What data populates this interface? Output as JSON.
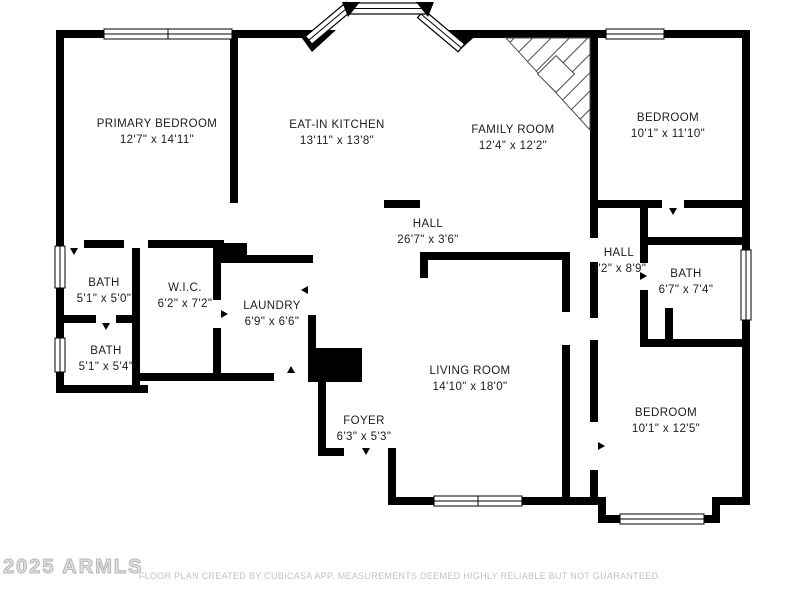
{
  "rooms": {
    "primary_bedroom": {
      "name": "PRIMARY BEDROOM",
      "dims": "12'7\" x 14'11\""
    },
    "eat_in_kitchen": {
      "name": "EAT-IN KITCHEN",
      "dims": "13'11\" x 13'8\""
    },
    "family_room": {
      "name": "FAMILY ROOM",
      "dims": "12'4\" x 12'2\""
    },
    "bedroom_top_right": {
      "name": "BEDROOM",
      "dims": "10'1\" x 11'10\""
    },
    "hall_main": {
      "name": "HALL",
      "dims": "26'7\" x 3'6\""
    },
    "hall_right": {
      "name": "HALL",
      "dims": "3'2\" x 8'9\""
    },
    "bath_right": {
      "name": "BATH",
      "dims": "6'7\" x 7'4\""
    },
    "bath_upper_left": {
      "name": "BATH",
      "dims": "5'1\" x 5'0\""
    },
    "wic": {
      "name": "W.I.C.",
      "dims": "6'2\" x 7'2\""
    },
    "laundry": {
      "name": "LAUNDRY",
      "dims": "6'9\" x 6'6\""
    },
    "bath_lower_left": {
      "name": "BATH",
      "dims": "5'1\" x 5'4\""
    },
    "living_room": {
      "name": "LIVING ROOM",
      "dims": "14'10\" x 18'0\""
    },
    "foyer": {
      "name": "FOYER",
      "dims": "6'3\" x 5'3\""
    },
    "bedroom_bottom_right": {
      "name": "BEDROOM",
      "dims": "10'1\" x 12'5\""
    }
  },
  "footer": {
    "watermark": "2025 ARMLS",
    "disclaimer": "FLOOR PLAN CREATED BY CUBICASA APP. MEASUREMENTS DEEMED HIGHLY RELIABLE BUT NOT GUARANTEED."
  },
  "colors": {
    "wall": "#000000",
    "background": "#ffffff",
    "hatch_line": "#4a4a4a",
    "label_text": "#1c1c1c",
    "footer_text": "#c2c2c2"
  }
}
